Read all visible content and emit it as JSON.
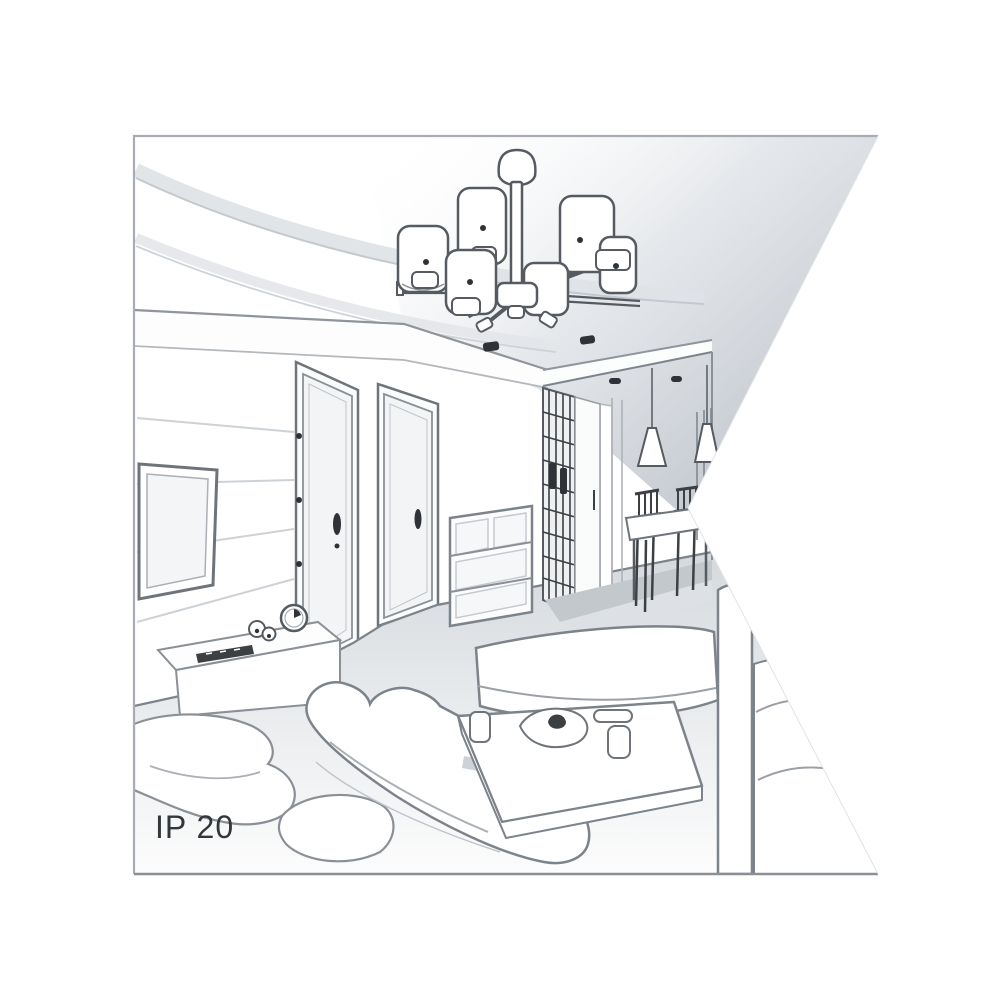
{
  "meta": {
    "type": "interior-line-art-illustration",
    "description": "Grayscale perspective sketch of a living room with a multi-shade ceiling chandelier, TV wall, two doors, hallway to a dining area with cone pendant lamps, sofas and a coffee table; the drawing is clipped by a triangular notch on its right edge"
  },
  "label": {
    "ip_rating": "IP 20"
  },
  "colors": {
    "background": "#ffffff",
    "frame_border": "#9aa0a6",
    "line_medium": "#6e747a",
    "line_light": "#b3b8bd",
    "line_dark": "#3c4043",
    "ceiling_shade": "#c9ced3",
    "floor_shade": "#dfe2e6",
    "label_text": "#33373c"
  },
  "elements": [
    "frame",
    "ceiling-cove",
    "tray-ceiling",
    "chandelier",
    "ceiling-downlights",
    "tv",
    "tv-wall-panel-lines",
    "door-left",
    "door-right",
    "tv-stand",
    "clock",
    "chest-of-drawers",
    "wardrobe-grid",
    "hallway",
    "pendant-lamps",
    "dining-table",
    "dining-chairs",
    "window",
    "sofa",
    "armchair",
    "chaise",
    "sofa-right-cushions",
    "coffee-table",
    "notch-cutout",
    "ip-rating-label"
  ]
}
